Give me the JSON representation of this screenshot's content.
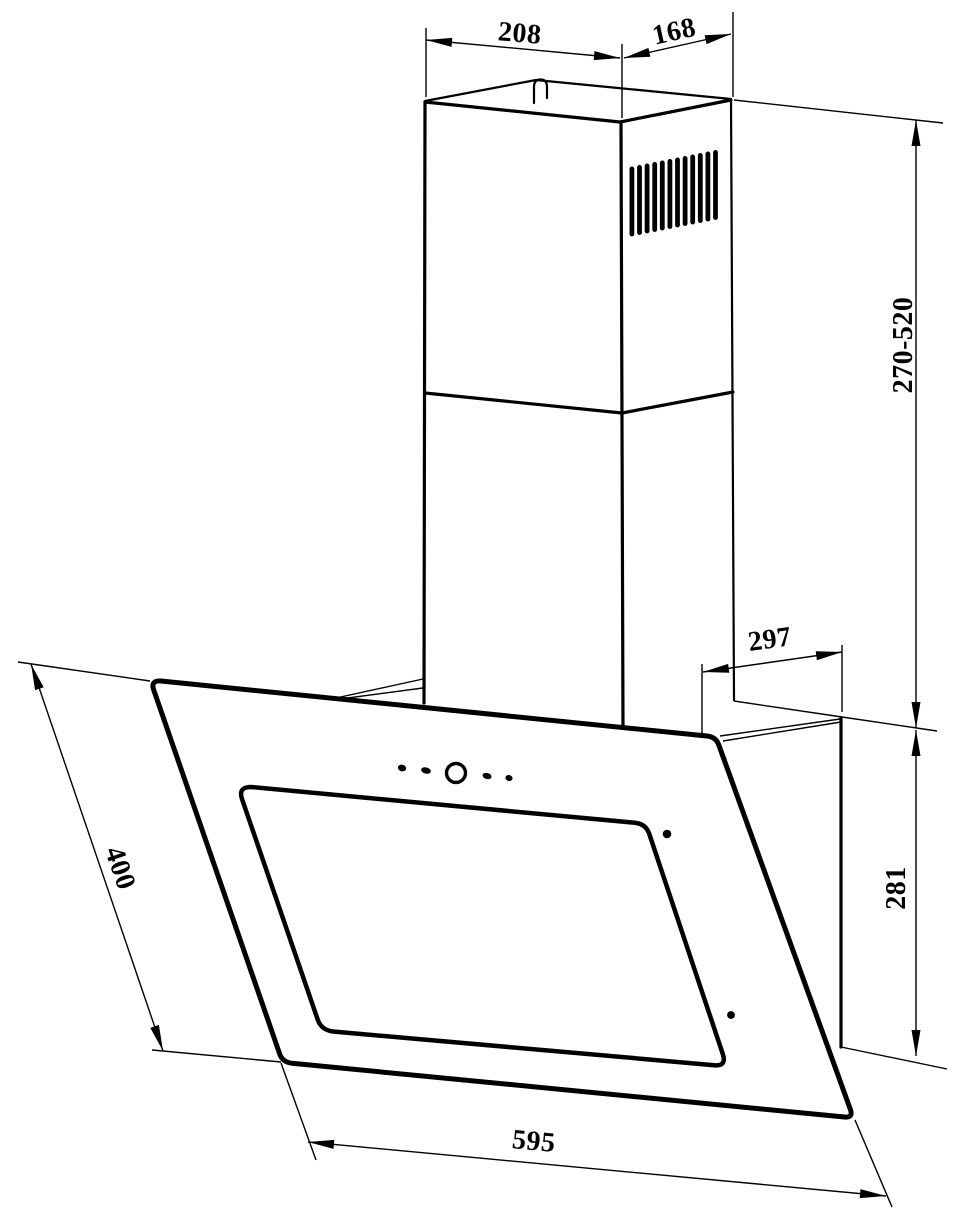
{
  "drawing": {
    "kind": "technical-dimension-drawing",
    "subject": "wall-mounted angled cooker hood with telescopic chimney",
    "colors": {
      "line": "#000000",
      "background": "#ffffff"
    },
    "dimensions": {
      "duct_front_width": "208",
      "duct_side_depth": "168",
      "chimney_height_range": "270-520",
      "top_rear_depth": "297",
      "rear_height": "281",
      "panel_slant_length": "400",
      "body_width": "595"
    }
  }
}
